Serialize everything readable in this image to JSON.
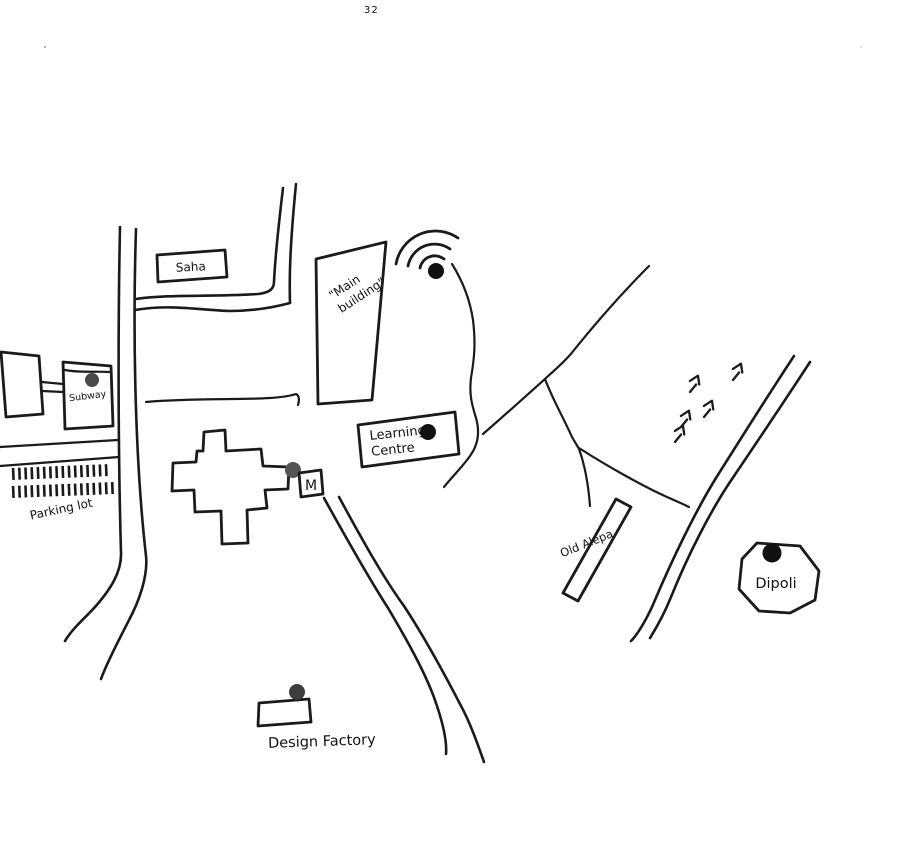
{
  "page": {
    "number": "32"
  },
  "colors": {
    "ink": "#1a1a1a",
    "paper": "#ffffff",
    "dot_black": "#111111",
    "dot_grey": "#4a4a4a"
  },
  "labels": {
    "saha": "Saha",
    "subway": "Subway",
    "parking_lot": "Parking lot",
    "main_building_line1": "\"Main",
    "main_building_line2": "building\"",
    "learning_line1": "Learning",
    "learning_line2": "Centre",
    "metro": "M",
    "old_alepa": "Old Alepa",
    "dipoli": "Dipoli",
    "design_factory": "Design Factory"
  },
  "arrows": {
    "angle": 18,
    "positions": [
      {
        "x": 690,
        "y": 392
      },
      {
        "x": 733,
        "y": 380
      },
      {
        "x": 704,
        "y": 417
      },
      {
        "x": 681,
        "y": 427
      },
      {
        "x": 675,
        "y": 442
      }
    ]
  }
}
